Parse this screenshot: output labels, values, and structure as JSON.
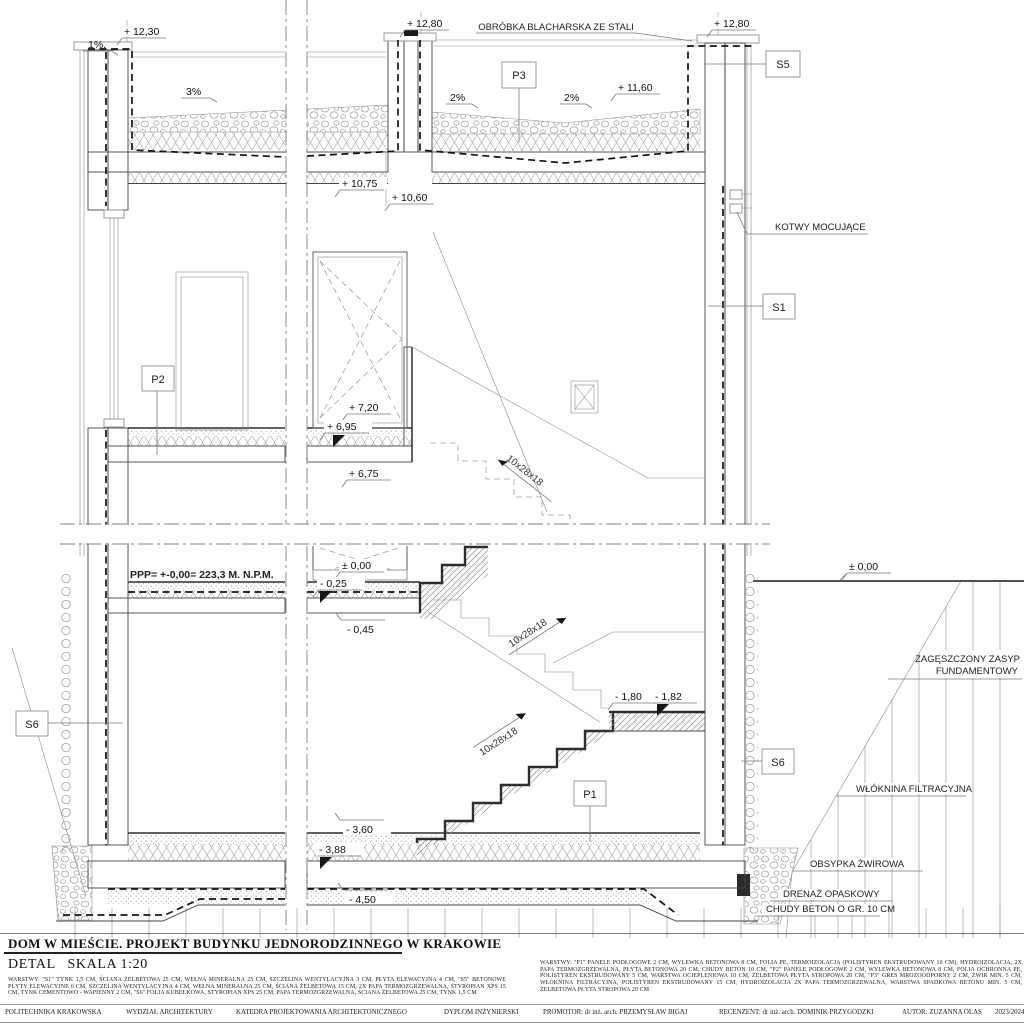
{
  "drawing": {
    "levels": {
      "p12_30": "+ 12,30",
      "p12_80": "+ 12,80",
      "p11_60": "+ 11,60",
      "p10_75": "+ 10,75",
      "p10_60": "+ 10,60",
      "p7_20": "+ 7,20",
      "p6_95": "+ 6,95",
      "p6_75": "+ 6,75",
      "z0_00": "± 0,00",
      "m0_25": "- 0,25",
      "m0_45": "- 0,45",
      "m1_80": "- 1,80",
      "m1_82": "- 1,82",
      "m3_60": "- 3,60",
      "m3_88": "- 3,88",
      "m4_50": "- 4,50"
    },
    "slopes": {
      "s1": "1%.",
      "s3": "3%",
      "s2": "2%"
    },
    "stair_label": "10x28x18",
    "tags": {
      "p1": "P1",
      "p2": "P2",
      "p3": "P3",
      "s1": "S1",
      "s5": "S5",
      "s6": "S6"
    },
    "callouts": {
      "flashing": "OBRÓBKA BLACHARSKA ZE STALI",
      "anchors": "KOTWY MOCUJĄCE",
      "backfill_1": "ZAGĘSZCZONY ZASYP",
      "backfill_2": "FUNDAMENTOWY",
      "geotextile": "WŁÓKNINA FILTRACYJNA",
      "gravel": "OBSYPKA ŻWIROWA",
      "drainage": "DRENAŻ OPASKOWY",
      "lean_concrete": "CHUDY BETON O GR. 10 CM",
      "datum": "PPP= +-0,00= 223,3 M. N.P.M."
    }
  },
  "title_block": {
    "project_title": "DOM W MIEŚCIE. PROJEKT BUDYNKU JEDNORODZINNEGO W KRAKOWIE",
    "detail_scale": "DETAL   SKALA 1:20",
    "layers_s": "WARSTWY: \"S1\" TYNK 1,5 CM, ŚCIANA ŻELBETOWA 25 CM, WEŁNA MINERALNA 25 CM, SZCZELINA WENTYLACYJNA 3 CM, PŁYTA ELEWACYJNA 4 CM, \"S5\" BETONOWE PŁYTY ELEWACYJNE 6 CM, SZCZELINA WENTYLACYJNA 4 CM, WEŁNA MINERALNA 25 CM, ŚCIANA ŻELBETOWA 15 CM, 2X PAPA TERMOZGRZEWALNA, STYROPIAN XPS 15 CM, TYNK CEMENTOWO - WAPIENNY 2 CM, \"S6\" FOLIA KUBEŁKOWA, STYROPIAN XPS 25 CM, PAPA TERMOZGRZEWALNA, ŚCIANA ŻELBETOWA 25 CM, TYNK 1,5 CM",
    "layers_p": "WARSTWY: \"P1\" PANELE PODŁOGOWE 2 CM, WYLEWKA BETONOWA 8 CM, FOLIA PE, TERMOIZOLACJA (POLISTYREN EKSTRUDOWANY 10 CM), HYDROIZOLACJA, 2X PAPA TERMOZGRZEWALNA, PŁYTA BETONOWA 20 CM, CHUDY BETON 10 CM, \"P2\" PANELE PODŁOGOWE 2 CM, WYLEWKA BETONOWA 8 CM, FOLIA OCHRONNA PE, POLISTYREN EKSTRUDOWANY 5 CM, WARSTWA OCIEPLENIOWA 10 CM, ŻELBETOWA PŁYTA STROPOWA 20 CM, \"P3\" GRES MROZOODPORNY 2 CM, ŻWIR MIN. 5 CM, WŁÓKNINA FILTRACYJNA, POLISTYREN EKSTRUDOWANY 15 CM, HYDROIZOLACJA 2X PAPA TERMOZGRZEWALNA, WARSTWA SPADKOWA BETONU MIN. 5 CM, ŻELBETOWA PŁYTA STROPOWA 20 CM"
  },
  "footer": {
    "university": "POLITECHNIKA KRAKOWSKA",
    "faculty": "WYDZIAŁ ARCHITEKTURY",
    "department": "KATEDRA PROJEKTOWANIA ARCHITEKTONICZNEGO",
    "thesis": "DYPLOM INŻYNIERSKI",
    "promoter": "PROMOTOR: dr inż. arch. PRZEMYSŁAW BIGAJ",
    "reviewer": "RECENZENT: dr inż. arch. DOMINIK PRZYGODZKI",
    "author": "AUTOR: ZUZANNA OLAS",
    "year": "2023/2024"
  }
}
